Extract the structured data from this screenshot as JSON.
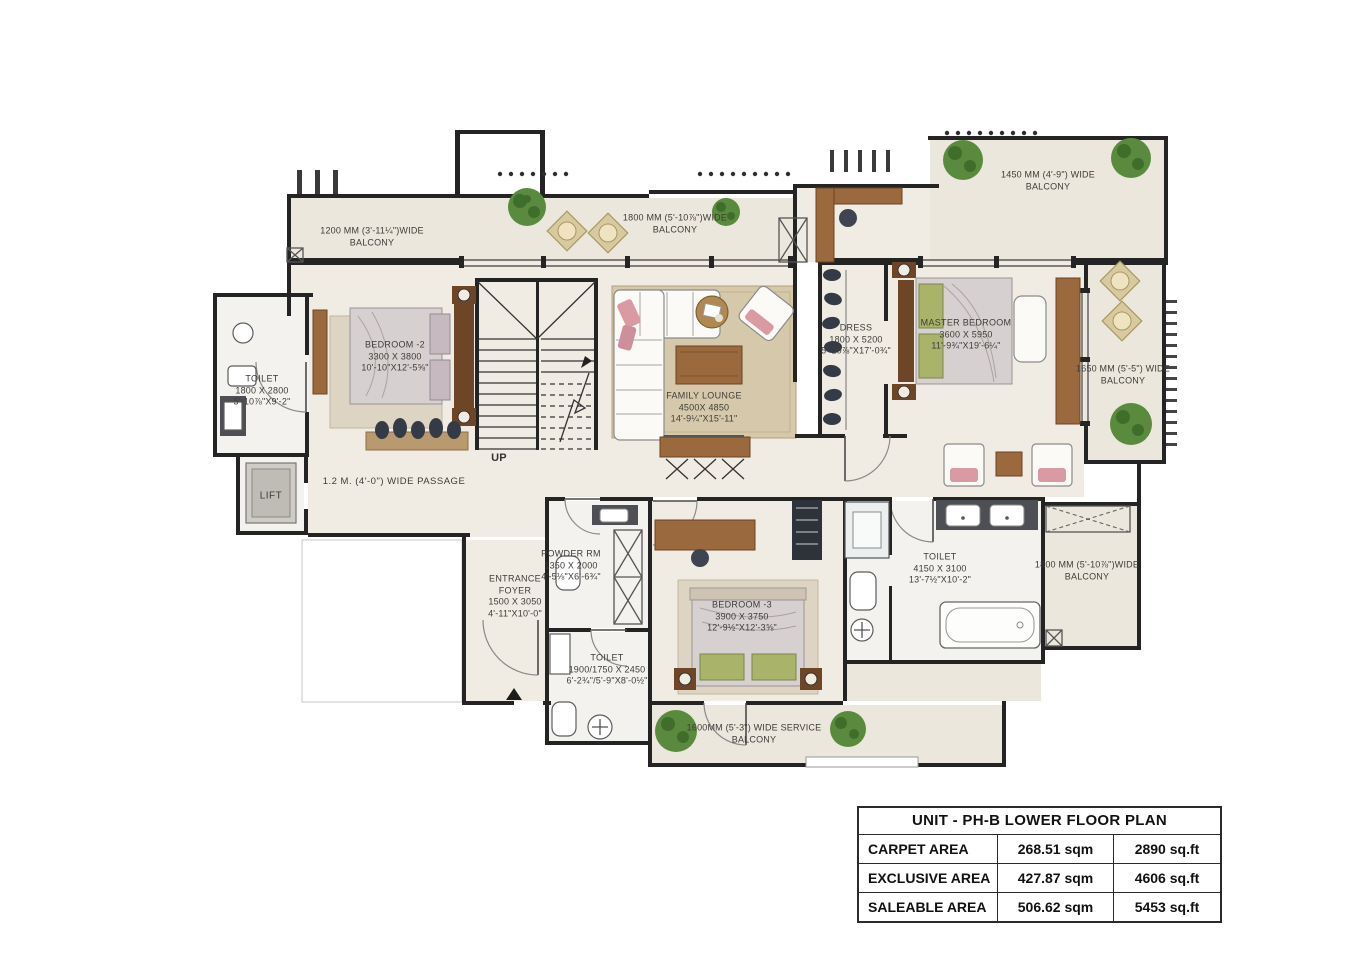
{
  "plan": {
    "rooms": {
      "bedroom2": {
        "name": "BEDROOM -2",
        "mm": "3300 X 3800",
        "ft": "10'-10\"X12'-5⅝\""
      },
      "toilet_bedroom2": {
        "name": "TOILET",
        "mm": "1800 X 2800",
        "ft": "5'-10⅞\"X9'-2\""
      },
      "lift": {
        "name": "LIFT"
      },
      "family_lounge": {
        "name": "FAMILY LOUNGE",
        "mm": "4500X 4850",
        "ft": "14'-9¼\"X15'-11\""
      },
      "dress": {
        "name": "DRESS",
        "mm": "1800 X 5200",
        "ft": "5'-10⅞\"X17'-0¾\""
      },
      "master_bedroom": {
        "name": "MASTER BEDROOM",
        "mm": "3600 X 5950",
        "ft": "11'-9¾\"X19'-6¼\""
      },
      "toilet_master": {
        "name": "TOILET",
        "mm": "4150 X 3100",
        "ft": "13'-7½\"X10'-2\""
      },
      "bedroom3": {
        "name": "BEDROOM -3",
        "mm": "3900 X 3750",
        "ft": "12'-9½\"X12'-3⅝\""
      },
      "powder_room": {
        "name": "POWDER RM",
        "mm": "1350 X 2000",
        "ft": "4'-5⅛\"X6'-6¾\""
      },
      "toilet_bedroom3": {
        "name": "TOILET",
        "mm": "1900/1750 X 2450",
        "ft": "6'-2¾\"/5'-9\"X8'-0½\""
      },
      "entrance_foyer": {
        "name": "ENTRANCE",
        "name2": "FOYER",
        "mm": "1500 X 3050",
        "ft": "4'-11\"X10'-0\""
      }
    },
    "balconies": {
      "top_left": {
        "l1": "1200 MM (3'-11¼\")WIDE",
        "l2": "BALCONY"
      },
      "top_center": {
        "l1": "1800 MM (5'-10⅞\")WIDE",
        "l2": "BALCONY"
      },
      "top_right": {
        "l1": "1450 MM (4'-9\") WIDE",
        "l2": "BALCONY"
      },
      "right": {
        "l1": "1650 MM (5'-5\") WIDE",
        "l2": "BALCONY"
      },
      "right_lower": {
        "l1": "1800 MM (5'-10⅞\")WIDE",
        "l2": "BALCONY"
      },
      "service": {
        "l1": "1600MM (5'-3\") WIDE SERVICE",
        "l2": "BALCONY"
      }
    },
    "annotations": {
      "passage": "1.2 M. (4'-0\") WIDE PASSAGE",
      "up": "UP"
    }
  },
  "area_table": {
    "title": "UNIT - PH-B LOWER FLOOR PLAN",
    "rows": [
      {
        "label": "CARPET AREA",
        "sqm": "268.51 sqm",
        "sqft": "2890 sq.ft"
      },
      {
        "label": "EXCLUSIVE AREA",
        "sqm": "427.87 sqm",
        "sqft": "4606 sq.ft"
      },
      {
        "label": "SALEABLE AREA",
        "sqm": "506.62 sqm",
        "sqft": "5453 sq.ft"
      }
    ]
  },
  "colors": {
    "wall": "#242424",
    "floor": "#f1ece3",
    "balcony": "#ebe7dd",
    "rug": "#d6c9ab",
    "wood": "#9a6a3e",
    "plant": "#5a8a3d",
    "bed": "#d6d1d0",
    "green_pillow": "#a9b46a",
    "pink_accent": "#d99aa4",
    "table_border": "#2b2b2b"
  }
}
